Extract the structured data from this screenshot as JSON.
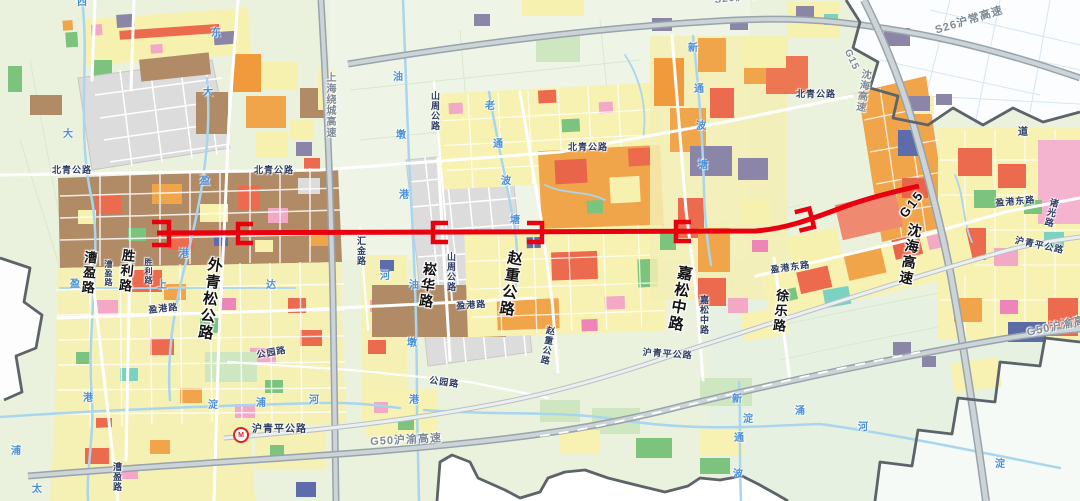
{
  "map": {
    "route": {
      "color": "#e8000f",
      "line_width": 5,
      "start": [
        157,
        233
      ],
      "end": [
        919,
        186
      ],
      "marker_xs": [
        160,
        245,
        440,
        534,
        683,
        805
      ]
    },
    "icons": {
      "metro_station": "shanghai-metro-logo",
      "metro_glyph": "M"
    },
    "labels": [
      {
        "t": "漕盈路",
        "x": 84,
        "y": 250,
        "k": "art",
        "v": 1,
        "fs": 13,
        "r": 5
      },
      {
        "t": "胜利路",
        "x": 122,
        "y": 248,
        "k": "art",
        "v": 1,
        "fs": 13,
        "r": 6
      },
      {
        "t": "外青松公路",
        "x": 208,
        "y": 256,
        "k": "art",
        "v": 1,
        "fs": 15,
        "r": 8
      },
      {
        "t": "崧华路",
        "x": 424,
        "y": 261,
        "k": "art",
        "v": 1,
        "fs": 14,
        "r": 7
      },
      {
        "t": "赵重公路",
        "x": 508,
        "y": 249,
        "k": "art",
        "v": 1,
        "fs": 15,
        "r": 9
      },
      {
        "t": "嘉松中路",
        "x": 678,
        "y": 264,
        "k": "art",
        "v": 1,
        "fs": 15,
        "r": 10
      },
      {
        "t": "徐乐路",
        "x": 776,
        "y": 288,
        "k": "art",
        "v": 1,
        "fs": 13,
        "r": 6
      },
      {
        "t": "G15",
        "x": 897,
        "y": 212,
        "k": "art",
        "v": 0,
        "fs": 13,
        "r": -52
      },
      {
        "t": "沈海高速",
        "x": 909,
        "y": 222,
        "k": "art",
        "v": 1,
        "fs": 14,
        "r": 10
      },
      {
        "t": "北青公路",
        "x": 52,
        "y": 166,
        "k": "road",
        "fs": 9
      },
      {
        "t": "北青公路",
        "x": 254,
        "y": 166,
        "k": "road",
        "fs": 9
      },
      {
        "t": "北青公路",
        "x": 568,
        "y": 143,
        "k": "road",
        "fs": 9
      },
      {
        "t": "北青公路",
        "x": 796,
        "y": 90,
        "k": "road",
        "fs": 9
      },
      {
        "t": "山周公路",
        "x": 430,
        "y": 91,
        "k": "road",
        "v": 1,
        "fs": 9
      },
      {
        "t": "山周公路",
        "x": 446,
        "y": 252,
        "k": "road",
        "v": 1,
        "fs": 9
      },
      {
        "t": "盈港路",
        "x": 148,
        "y": 306,
        "k": "road",
        "fs": 9,
        "r": -6
      },
      {
        "t": "盈港路",
        "x": 456,
        "y": 302,
        "k": "road",
        "fs": 9,
        "r": -4
      },
      {
        "t": "盈港东路",
        "x": 770,
        "y": 266,
        "k": "road",
        "fs": 9,
        "r": -8
      },
      {
        "t": "盈港东路",
        "x": 995,
        "y": 199,
        "k": "road",
        "fs": 9,
        "r": -5
      },
      {
        "t": "公园路",
        "x": 256,
        "y": 351,
        "k": "road",
        "fs": 9,
        "r": -10
      },
      {
        "t": "公园路",
        "x": 430,
        "y": 376,
        "k": "road",
        "fs": 9,
        "r": 8
      },
      {
        "t": "汇金路",
        "x": 356,
        "y": 236,
        "k": "road",
        "v": 1,
        "fs": 9
      },
      {
        "t": "沪青平公路",
        "x": 252,
        "y": 425,
        "k": "road",
        "fs": 10
      },
      {
        "t": "沪青平公路",
        "x": 643,
        "y": 348,
        "k": "road",
        "fs": 9,
        "r": 4
      },
      {
        "t": "沪青平公路",
        "x": 1016,
        "y": 236,
        "k": "road",
        "fs": 9,
        "r": 12
      },
      {
        "t": "诸光路",
        "x": 1050,
        "y": 197,
        "k": "road",
        "v": 1,
        "fs": 9,
        "r": 14
      },
      {
        "t": "漕盈路",
        "x": 112,
        "y": 462,
        "k": "road",
        "v": 1,
        "fs": 9
      },
      {
        "t": "漕盈路",
        "x": 104,
        "y": 260,
        "k": "road",
        "v": 1,
        "fs": 8
      },
      {
        "t": "胜利路",
        "x": 144,
        "y": 258,
        "k": "road",
        "v": 1,
        "fs": 8
      },
      {
        "t": "赵重公路",
        "x": 546,
        "y": 325,
        "k": "road",
        "v": 1,
        "fs": 9,
        "r": 10
      },
      {
        "t": "嘉松中路",
        "x": 699,
        "y": 295,
        "k": "road",
        "v": 1,
        "fs": 9
      },
      {
        "t": "道",
        "x": 1018,
        "y": 128,
        "k": "road",
        "fs": 10
      },
      {
        "t": "S26沪常高速",
        "x": 714,
        "y": -4,
        "k": "hwy",
        "fs": 10,
        "r": -6
      },
      {
        "t": "S26沪常高速",
        "x": 934,
        "y": 26,
        "k": "hwy",
        "fs": 11,
        "r": -17
      },
      {
        "t": "G15",
        "x": 851,
        "y": 48,
        "k": "hwy",
        "fs": 10,
        "r": 65
      },
      {
        "t": "沈海高速",
        "x": 860,
        "y": 68,
        "k": "hwy",
        "v": 1,
        "fs": 10,
        "r": 9
      },
      {
        "t": "上海绕城高速",
        "x": 324,
        "y": 72,
        "k": "hwy",
        "v": 1,
        "fs": 10
      },
      {
        "t": "G50沪渝高速",
        "x": 370,
        "y": 437,
        "k": "hwy",
        "fs": 11,
        "r": -3
      },
      {
        "t": "G50沪渝高速",
        "x": 1026,
        "y": 328,
        "k": "hwy",
        "fs": 11,
        "r": -12
      },
      {
        "t": "西",
        "x": 77,
        "y": -2,
        "k": "river",
        "fs": 10
      },
      {
        "t": "东",
        "x": 211,
        "y": 29,
        "k": "river",
        "fs": 10
      },
      {
        "t": "大",
        "x": 63,
        "y": 130,
        "k": "river",
        "fs": 10
      },
      {
        "t": "大",
        "x": 203,
        "y": 88,
        "k": "river",
        "fs": 10
      },
      {
        "t": "盈",
        "x": 200,
        "y": 177,
        "k": "river",
        "fs": 10
      },
      {
        "t": "盈",
        "x": 70,
        "y": 280,
        "k": "river",
        "fs": 10
      },
      {
        "t": "港",
        "x": 179,
        "y": 250,
        "k": "river",
        "fs": 10
      },
      {
        "t": "港",
        "x": 83,
        "y": 394,
        "k": "river",
        "fs": 10
      },
      {
        "t": "上",
        "x": 157,
        "y": 281,
        "k": "river",
        "fs": 10
      },
      {
        "t": "达",
        "x": 266,
        "y": 281,
        "k": "river",
        "fs": 10
      },
      {
        "t": "油",
        "x": 393,
        "y": 73,
        "k": "river",
        "fs": 10
      },
      {
        "t": "墩",
        "x": 396,
        "y": 131,
        "k": "river",
        "fs": 10
      },
      {
        "t": "港",
        "x": 399,
        "y": 191,
        "k": "river",
        "fs": 10
      },
      {
        "t": "油",
        "x": 409,
        "y": 281,
        "k": "river",
        "fs": 10
      },
      {
        "t": "墩",
        "x": 407,
        "y": 339,
        "k": "river",
        "fs": 10
      },
      {
        "t": "港",
        "x": 409,
        "y": 396,
        "k": "river",
        "fs": 10
      },
      {
        "t": "老",
        "x": 485,
        "y": 102,
        "k": "river",
        "fs": 10
      },
      {
        "t": "通",
        "x": 493,
        "y": 140,
        "k": "river",
        "fs": 10
      },
      {
        "t": "波",
        "x": 501,
        "y": 177,
        "k": "river",
        "fs": 10
      },
      {
        "t": "塘",
        "x": 510,
        "y": 216,
        "k": "river",
        "fs": 10
      },
      {
        "t": "新",
        "x": 688,
        "y": 44,
        "k": "river",
        "fs": 10
      },
      {
        "t": "通",
        "x": 694,
        "y": 85,
        "k": "river",
        "fs": 10
      },
      {
        "t": "波",
        "x": 696,
        "y": 122,
        "k": "river",
        "fs": 10
      },
      {
        "t": "塘",
        "x": 698,
        "y": 161,
        "k": "river",
        "fs": 10
      },
      {
        "t": "新",
        "x": 732,
        "y": 395,
        "k": "river",
        "fs": 10
      },
      {
        "t": "淀",
        "x": 743,
        "y": 415,
        "k": "river",
        "fs": 10
      },
      {
        "t": "通",
        "x": 734,
        "y": 434,
        "k": "river",
        "fs": 10
      },
      {
        "t": "波",
        "x": 733,
        "y": 470,
        "k": "river",
        "fs": 10
      },
      {
        "t": "淀",
        "x": 208,
        "y": 401,
        "k": "river",
        "fs": 10
      },
      {
        "t": "浦",
        "x": 256,
        "y": 399,
        "k": "river",
        "fs": 10
      },
      {
        "t": "河",
        "x": 309,
        "y": 396,
        "k": "river",
        "fs": 10
      },
      {
        "t": "河",
        "x": 380,
        "y": 272,
        "k": "river",
        "fs": 10
      },
      {
        "t": "涌",
        "x": 795,
        "y": 407,
        "k": "river",
        "fs": 10
      },
      {
        "t": "河",
        "x": 858,
        "y": 423,
        "k": "river",
        "fs": 10
      },
      {
        "t": "浦",
        "x": 11,
        "y": 447,
        "k": "river",
        "fs": 10
      },
      {
        "t": "太",
        "x": 32,
        "y": 485,
        "k": "river",
        "fs": 10
      },
      {
        "t": "淀",
        "x": 995,
        "y": 460,
        "k": "river",
        "fs": 10
      }
    ]
  }
}
